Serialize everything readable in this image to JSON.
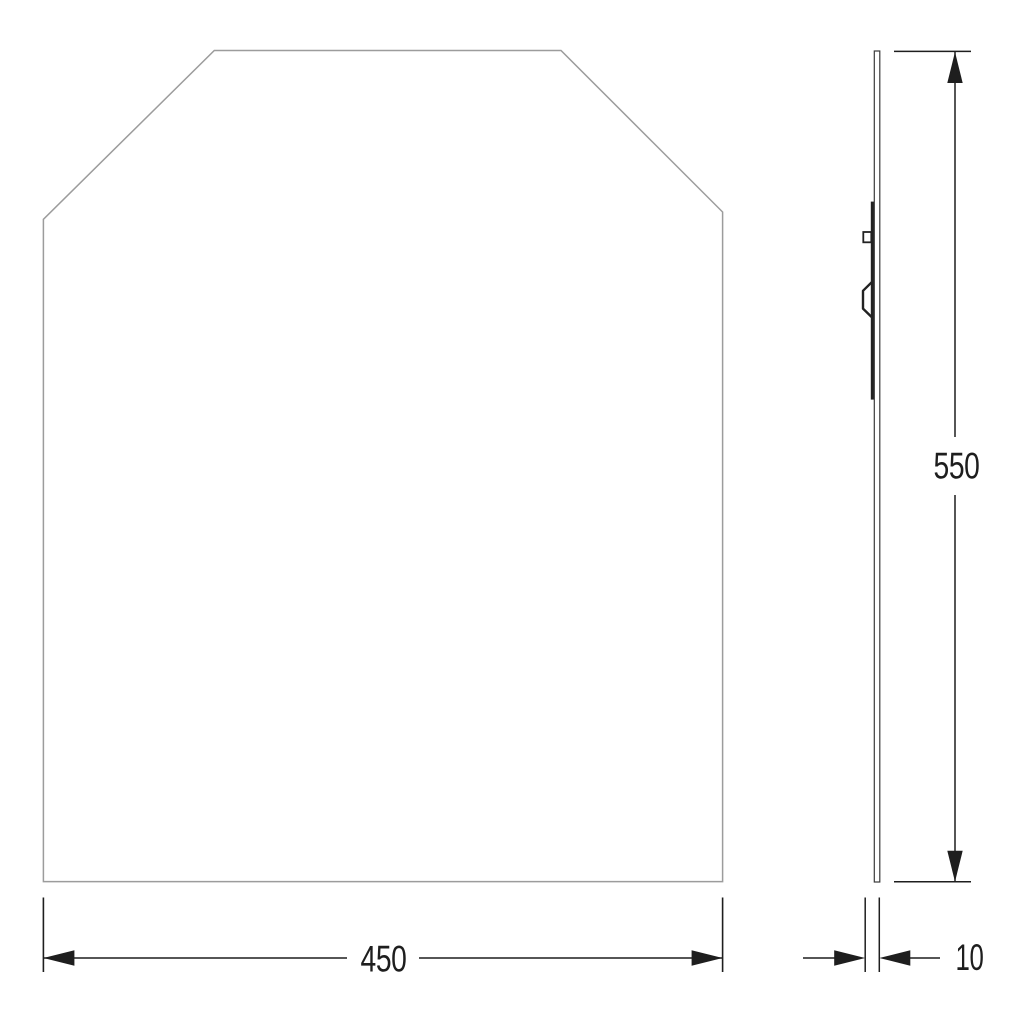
{
  "drawing": {
    "labels": {
      "width": "450",
      "height": "550",
      "depth": "10"
    },
    "colors": {
      "background": "#ffffff",
      "front_outline": "#9c9c9c",
      "side_outline": "#3a3a3a",
      "bracket": "#222222",
      "dimension": "#1e1e1e"
    }
  }
}
